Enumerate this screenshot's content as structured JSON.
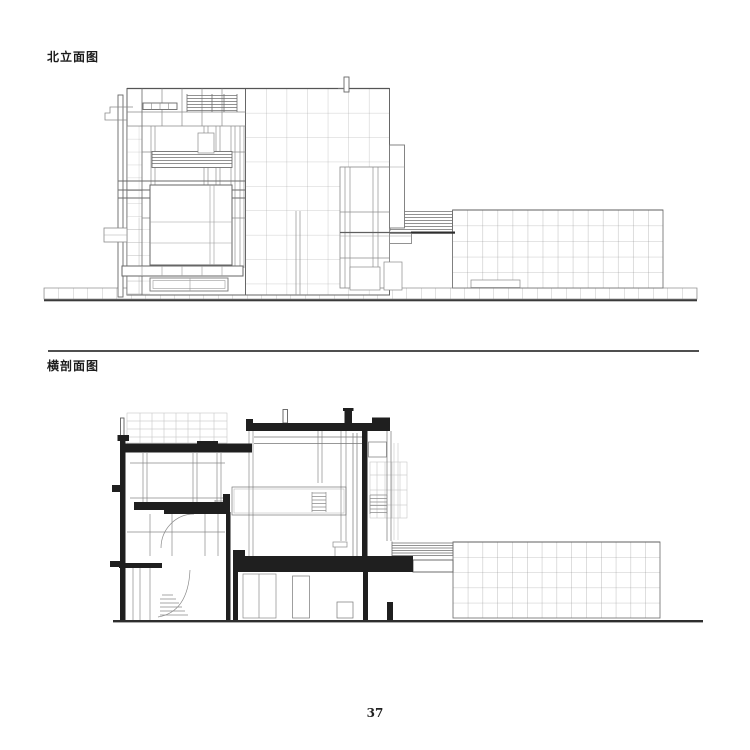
{
  "labels": {
    "top": "北立面图",
    "bottom": "横剖面图"
  },
  "page_number": "37",
  "colors": {
    "paper": "#ffffff",
    "ink_thin": "#8a8a8a",
    "ink_medium": "#5f5f5f",
    "ink_heavy": "#2e2e2e",
    "poche_fill": "#1f1f1f"
  }
}
